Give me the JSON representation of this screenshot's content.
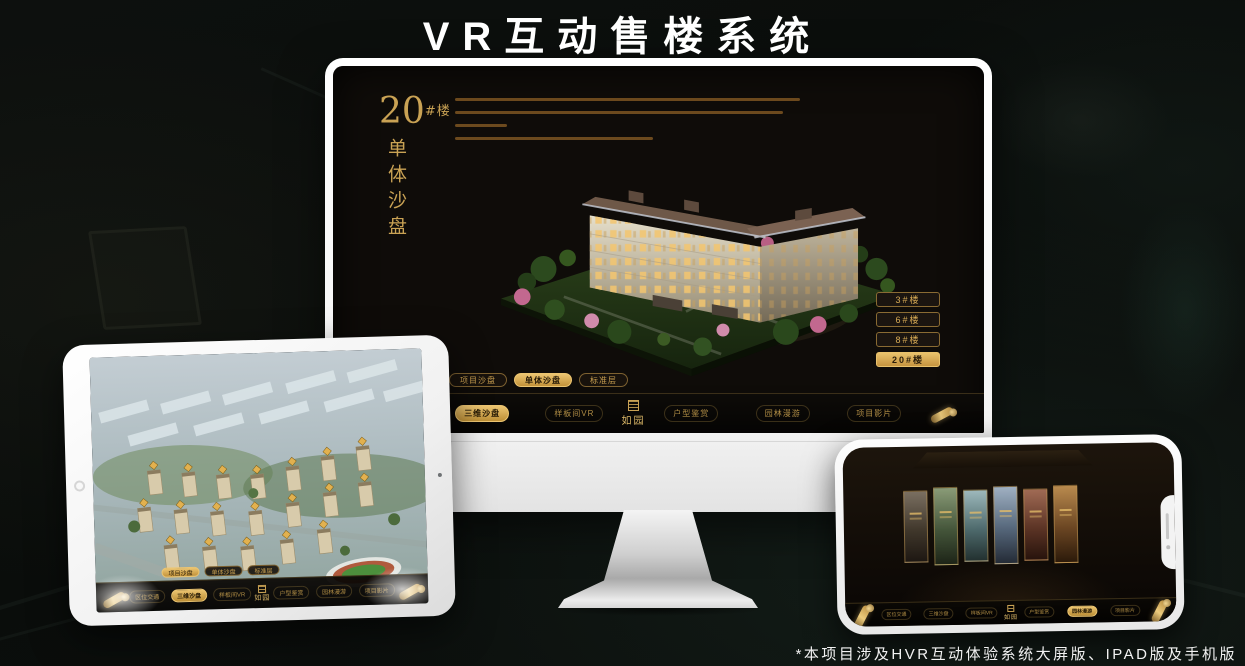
{
  "page": {
    "title": "VR互动售楼系统",
    "footnote": "*本项目涉及HVR互动体验系统大屏版、IPAD版及手机版"
  },
  "colors": {
    "gold": "#c9a254",
    "gold_bright": "#ecc571",
    "screen_bg": "#0f0c09",
    "nav_text": "#b08d45"
  },
  "monitor_ui": {
    "heading": {
      "number": "20",
      "suffix": "#楼",
      "subtitle_vertical": "单体沙盘"
    },
    "building_buttons": [
      {
        "label": "3#楼"
      },
      {
        "label": "6#楼"
      },
      {
        "label": "8#楼"
      },
      {
        "label": "20#楼",
        "active": true
      }
    ],
    "sub_tabs": [
      {
        "label": "项目沙盘"
      },
      {
        "label": "单体沙盘",
        "active": true
      },
      {
        "label": "标准层"
      }
    ],
    "nav": {
      "left_items": [
        {
          "label": "区位交通"
        },
        {
          "label": "三维沙盘",
          "active": true
        },
        {
          "label": "样板间VR"
        }
      ],
      "right_items": [
        {
          "label": "户型鉴赏"
        },
        {
          "label": "园林漫游"
        },
        {
          "label": "项目影片"
        }
      ],
      "logo": "如园"
    }
  },
  "tablet_ui": {
    "sub_tabs": [
      {
        "label": "项目沙盘",
        "active": true
      },
      {
        "label": "单体沙盘"
      },
      {
        "label": "标准层"
      }
    ],
    "nav": {
      "left_items": [
        {
          "label": "区位交通"
        },
        {
          "label": "三维沙盘",
          "active": true
        },
        {
          "label": "样板间VR"
        }
      ],
      "right_items": [
        {
          "label": "户型鉴赏"
        },
        {
          "label": "园林漫游"
        },
        {
          "label": "项目影片"
        }
      ],
      "logo": "如园"
    }
  },
  "phone_ui": {
    "nav": {
      "left_items": [
        {
          "label": "区位交通"
        },
        {
          "label": "三维沙盘"
        },
        {
          "label": "样板间VR"
        }
      ],
      "right_items": [
        {
          "label": "户型鉴赏"
        },
        {
          "label": "园林漫游",
          "active": true
        },
        {
          "label": "项目影片"
        }
      ],
      "logo": "如园"
    },
    "panels": [
      {
        "tone": "stone"
      },
      {
        "tone": "courtyard"
      },
      {
        "tone": "aerial"
      },
      {
        "tone": "tower"
      },
      {
        "tone": "gate"
      },
      {
        "tone": "wood"
      }
    ]
  }
}
